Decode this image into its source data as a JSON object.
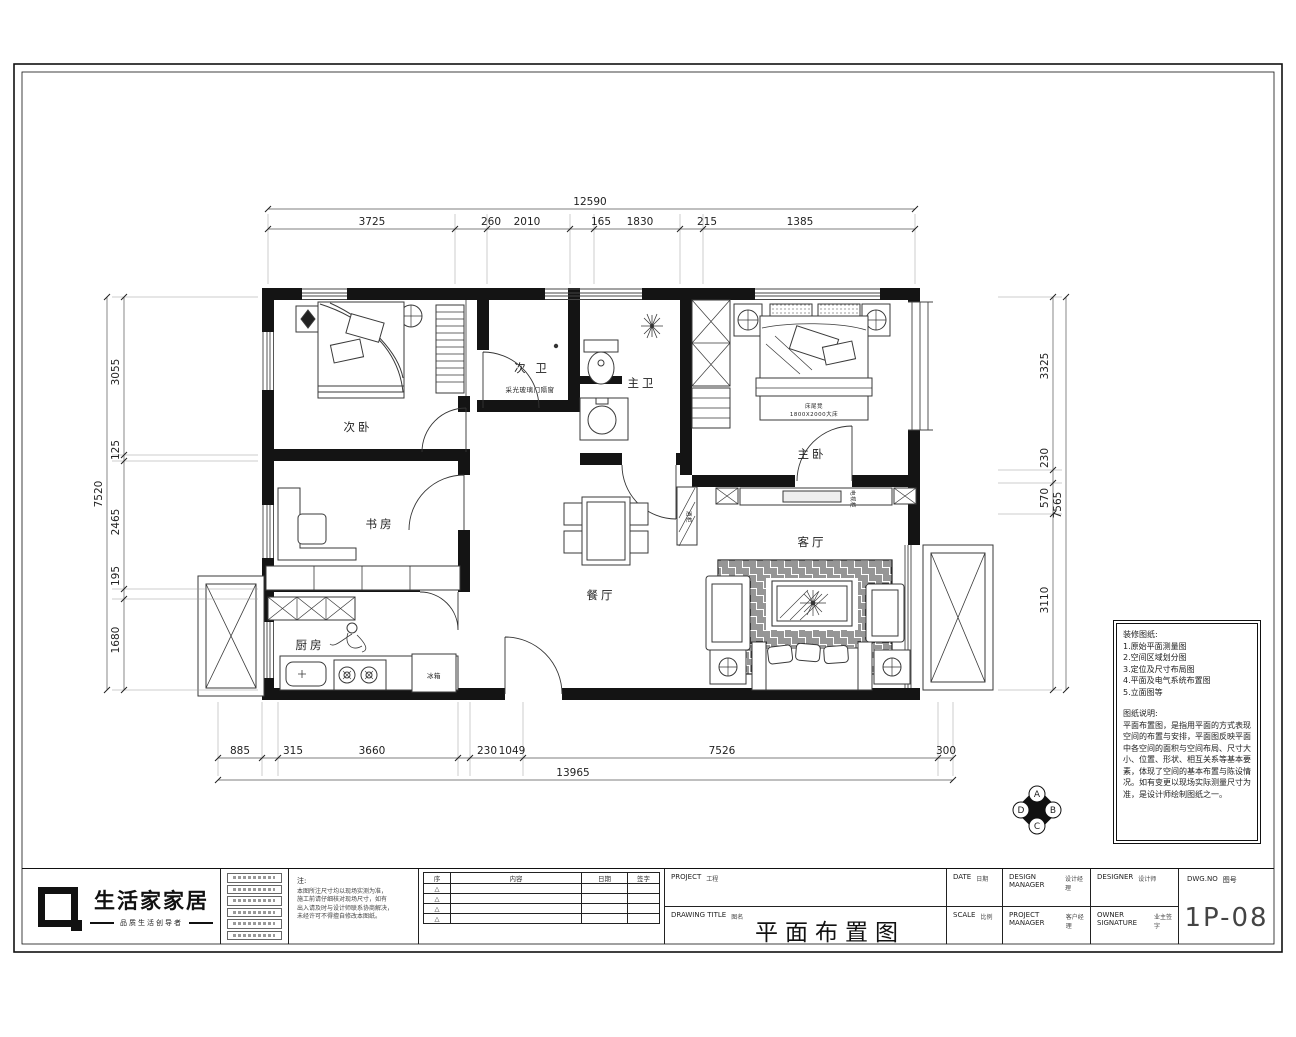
{
  "sheet": {
    "drawing_number": "1P-08",
    "title_cn": "平面布置图"
  },
  "logo": {
    "name": "生活家家居",
    "tagline": "品质生活创导者"
  },
  "rooms": {
    "bedroom2": {
      "label": "次卧"
    },
    "study": {
      "label": "书房"
    },
    "kitchen": {
      "label": "厨房"
    },
    "bath2": {
      "label": "次 卫"
    },
    "bath1": {
      "label": "主卫"
    },
    "master": {
      "label": "主卧"
    },
    "dining": {
      "label": "餐厅"
    },
    "living": {
      "label": "客厅"
    }
  },
  "annotations": {
    "partition_note": "采光玻璃门隔窗",
    "bed_note1": "床尾凳",
    "bed_note2": "1800X2000大床",
    "fridge": "冰箱",
    "tv_cabinet": "电视柜",
    "wine_cabinet": "酒柜"
  },
  "dims": {
    "top": {
      "total": "12590",
      "segments": [
        "3725",
        "260",
        "2010",
        "165",
        "1830",
        "215",
        "1385"
      ]
    },
    "bottom": {
      "total": "13965",
      "segments": [
        "885",
        "315",
        "3660",
        "230",
        "1049",
        "7526",
        "300"
      ]
    },
    "left": {
      "total": "7520",
      "segments": [
        "3055",
        "125",
        "2465",
        "195",
        "1680"
      ]
    },
    "right": {
      "total": "7565",
      "segments": [
        "3325",
        "230",
        "570",
        "3110"
      ]
    }
  },
  "compass": {
    "a": "A",
    "b": "B",
    "c": "C",
    "d": "D"
  },
  "notes": {
    "title": "装修图纸:",
    "items": [
      "1.原始平面测量图",
      "2.空间区域划分图",
      "3.定位及尺寸布局图",
      "4.平面及电气系统布置图",
      "5.立面图等"
    ],
    "desc_title": "图纸说明:",
    "desc": "平面布置图，是指用平面的方式表现空间的布置与安排，平面图反映平面中各空间的面积与空间布局、尺寸大小、位置、形状、相互关系等基本要素，体现了空间的基本布置与陈设情况。如有变更以现场实际测量尺寸为准，是设计师绘制图纸之一。"
  },
  "titleblock": {
    "note_label": "注:",
    "note_lines": [
      "本图所注尺寸均以现场实测为准，",
      "施工前请仔细核对现场尺寸，如有",
      "出入请及时与设计师联系协商解决，",
      "未经许可不得擅自修改本图纸。"
    ],
    "rev_headers": [
      "序",
      "内容",
      "日期",
      "签字"
    ],
    "rev_mark": "△",
    "project_label": "PROJECT",
    "project_cn": "工程",
    "drawing_title_label": "DRAWING TITLE",
    "drawing_title_cn": "图名",
    "date_label": "DATE",
    "date_cn": "日期",
    "scale_label": "SCALE",
    "scale_cn": "比例",
    "design_manager_label": "DESIGN MANAGER",
    "design_manager_cn": "设计经理",
    "project_manager_label": "PROJECT MANAGER",
    "project_manager_cn": "客户经理",
    "designer_label": "DESIGNER",
    "designer_cn": "设计师",
    "owner_label": "OWNER SIGNATURE",
    "owner_cn": "业主签字",
    "dwgno_label": "DWG.NO",
    "dwgno_cn": "图号"
  }
}
